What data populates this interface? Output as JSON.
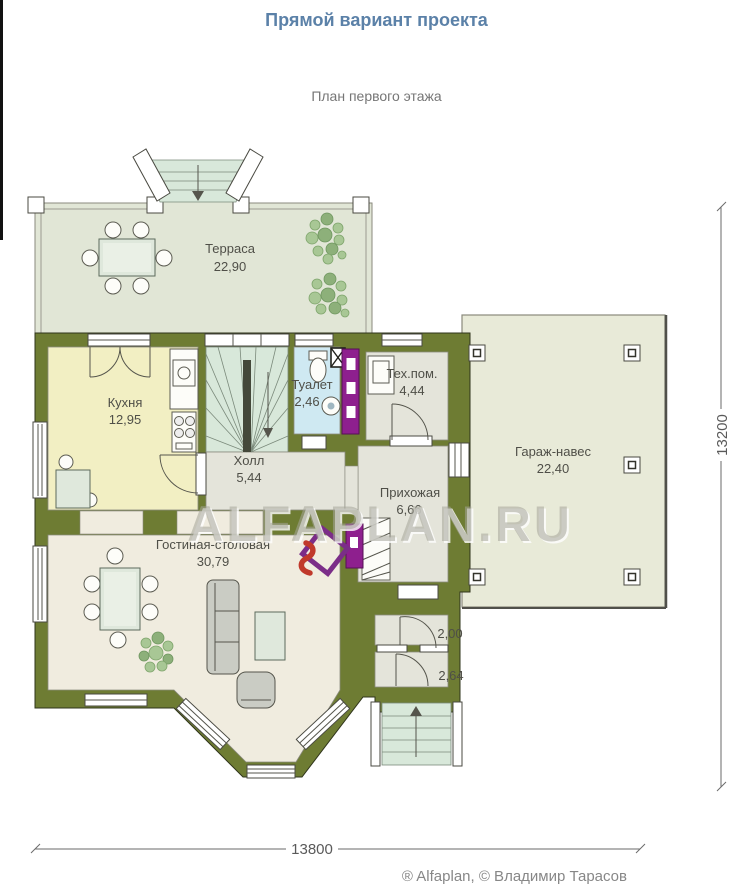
{
  "header": {
    "title": "Прямой вариант проекта",
    "subtitle": "План первого этажа"
  },
  "rooms": {
    "terrace": {
      "name": "Терраса",
      "area": "22,90"
    },
    "kitchen": {
      "name": "Кухня",
      "area": "12,95"
    },
    "toilet": {
      "name": "Туалет",
      "area": "2,46"
    },
    "tech": {
      "name": "Тех.пом.",
      "area": "4,44"
    },
    "hall": {
      "name": "Холл",
      "area": "5,44"
    },
    "entry": {
      "name": "Прихожая",
      "area": "6,66"
    },
    "garage": {
      "name": "Гараж-навес",
      "area": "22,40"
    },
    "living": {
      "name": "Гостиная-столовая",
      "area": "30,79"
    },
    "tambour": {
      "area": "2,00"
    },
    "porch": {
      "area": "2,64"
    }
  },
  "dimensions": {
    "width": "13800",
    "height": "13200"
  },
  "watermark": "ALFAPLAN.RU",
  "footer": {
    "copyright": "® Alfaplan, © Владимир Тарасов"
  },
  "colors": {
    "wall": "#6e7c33",
    "terrace_floor": "#e1e6d6",
    "kitchen_floor": "#f2efc3",
    "stairs_floor": "#d8e8da",
    "toilet_floor": "#cfe9f2",
    "gray_floor": "#e4e4da",
    "living_floor": "#f0ecdf",
    "garage_floor": "#e8ead8",
    "accent_purple": "#8e1f8e",
    "accent_red": "#c0392b",
    "title": "#5b81a8"
  }
}
